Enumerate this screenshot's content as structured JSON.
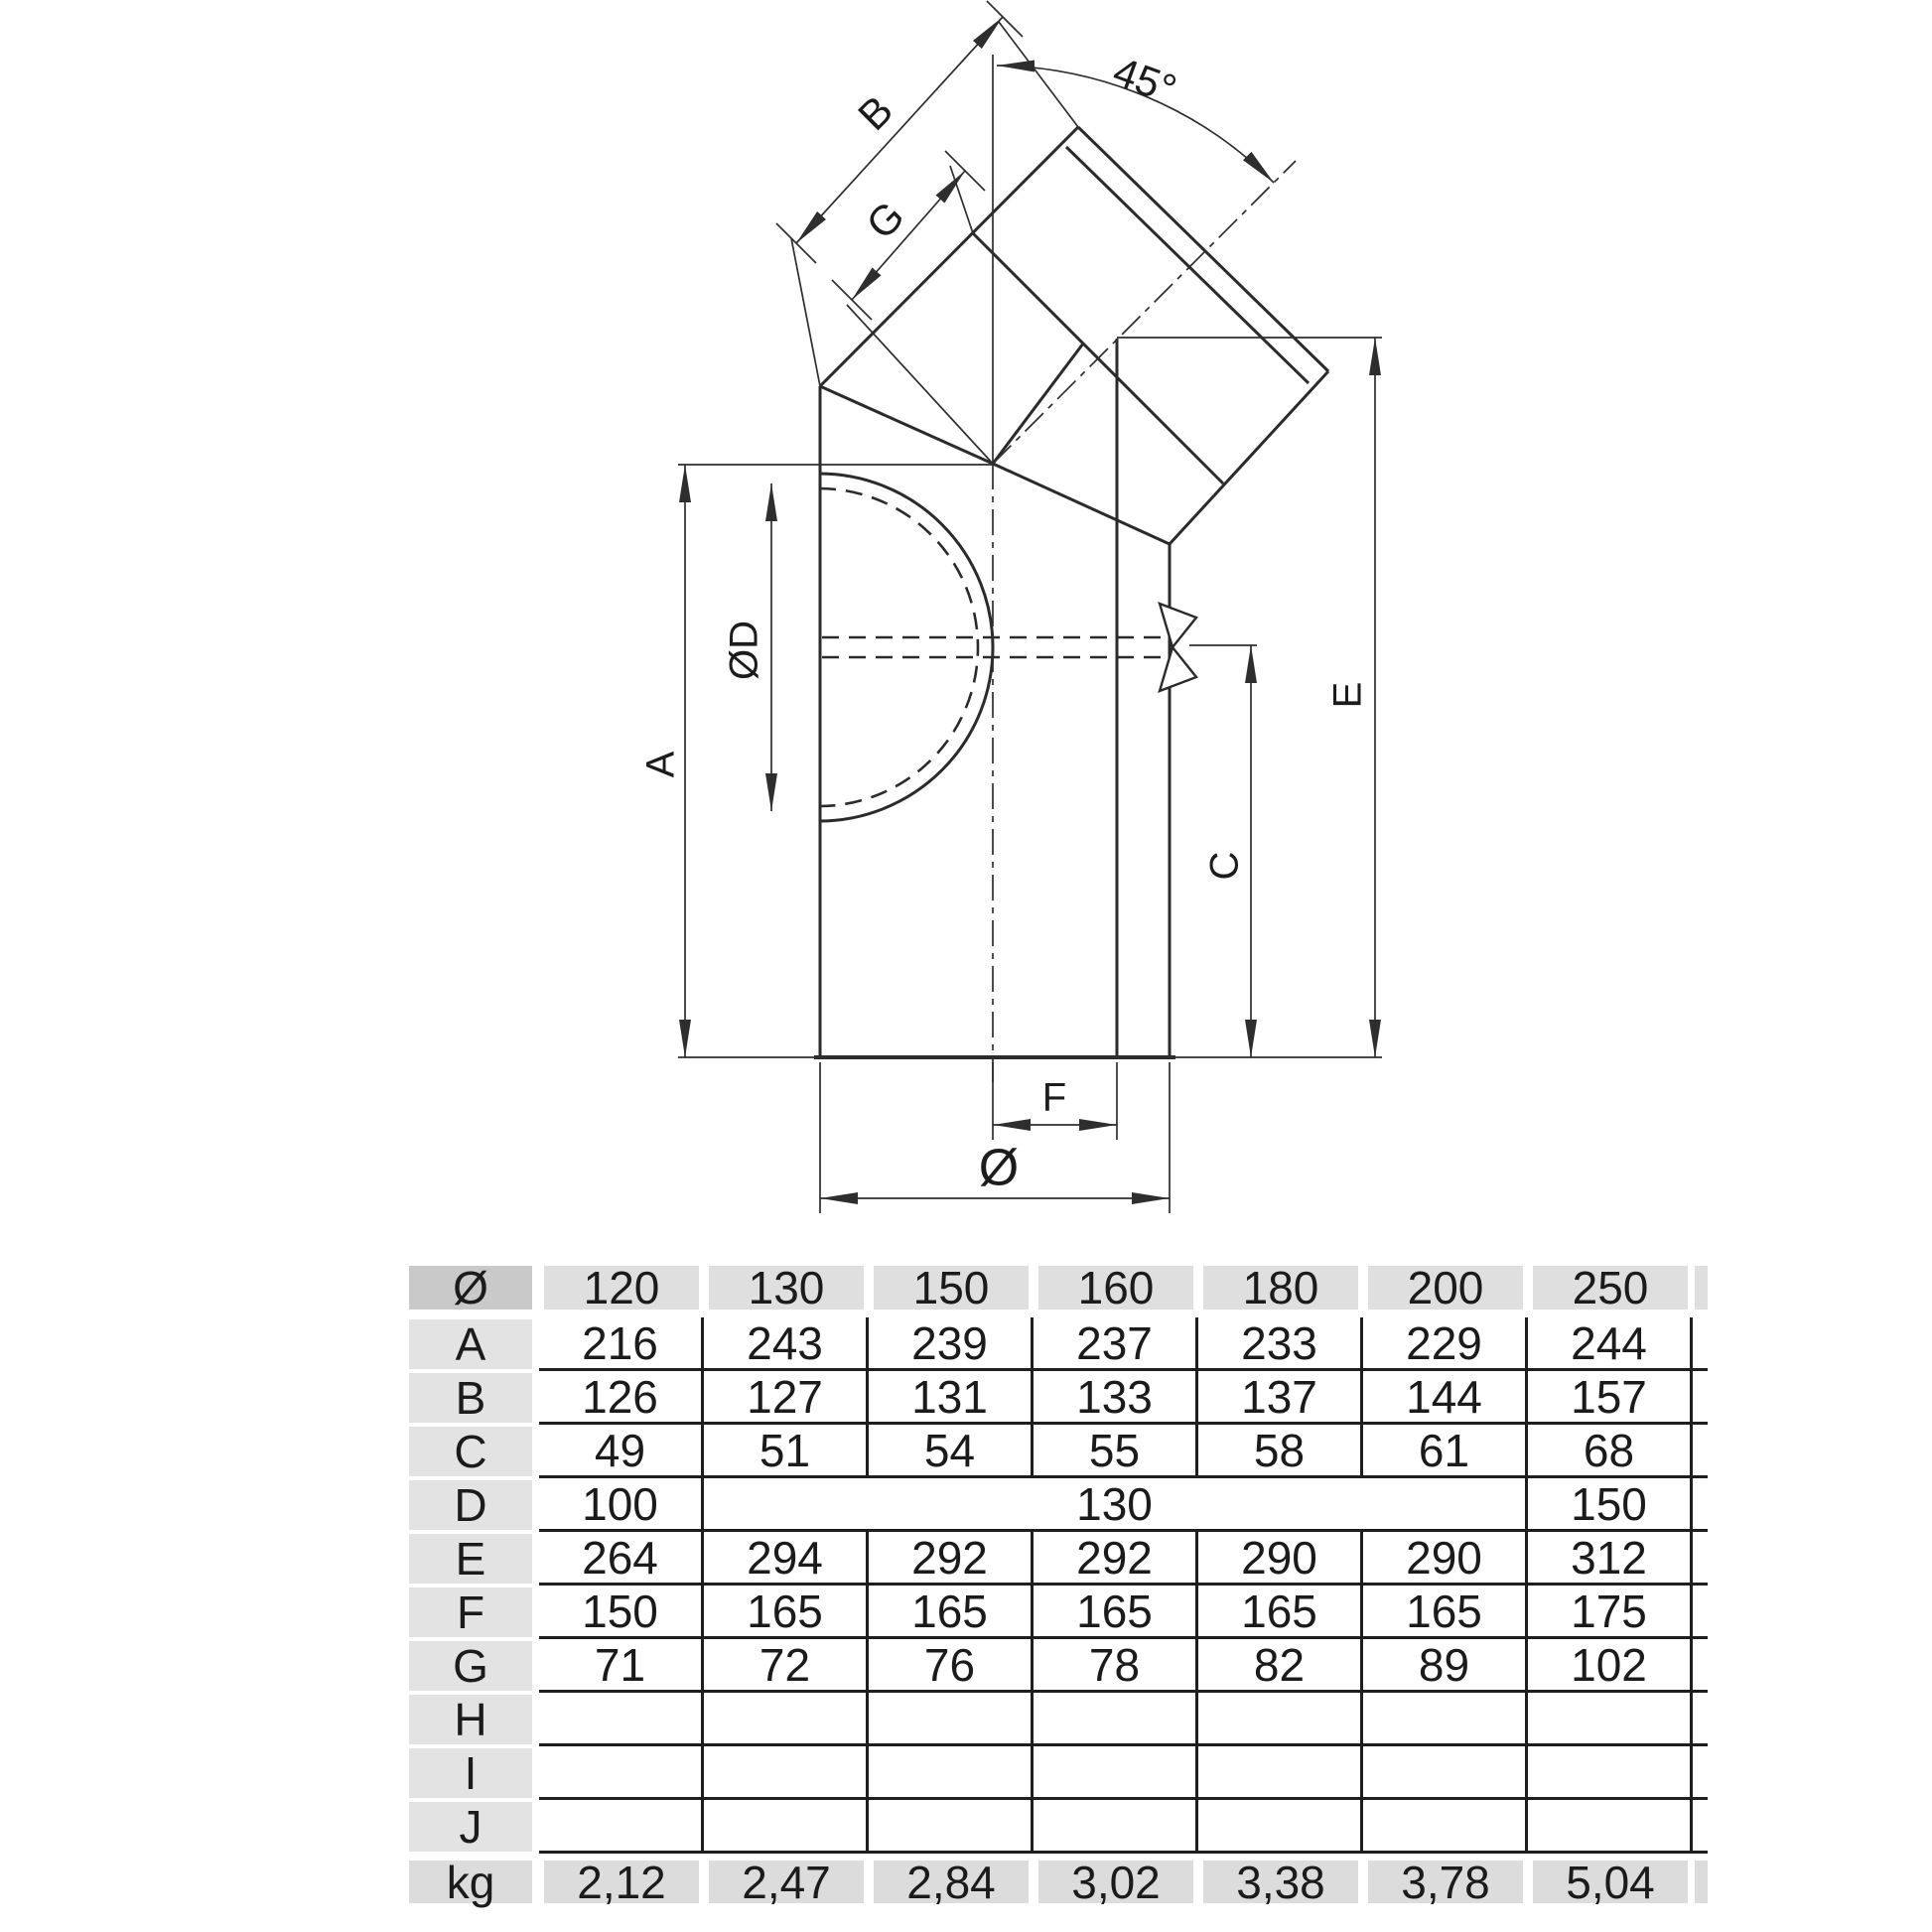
{
  "drawing": {
    "labels": {
      "a": "A",
      "b": "B",
      "c": "C",
      "d": "ØD",
      "e": "E",
      "f": "F",
      "g": "G",
      "diameter": "Ø",
      "angle": "45°"
    }
  },
  "table": {
    "header": {
      "label": "Ø",
      "values": [
        "120",
        "130",
        "150",
        "160",
        "180",
        "200",
        "250"
      ]
    },
    "rows": [
      {
        "label": "A",
        "cells": [
          {
            "v": "216"
          },
          {
            "v": "243"
          },
          {
            "v": "239"
          },
          {
            "v": "237"
          },
          {
            "v": "233"
          },
          {
            "v": "229"
          },
          {
            "v": "244"
          }
        ]
      },
      {
        "label": "B",
        "cells": [
          {
            "v": "126"
          },
          {
            "v": "127"
          },
          {
            "v": "131"
          },
          {
            "v": "133"
          },
          {
            "v": "137"
          },
          {
            "v": "144"
          },
          {
            "v": "157"
          }
        ]
      },
      {
        "label": "C",
        "cells": [
          {
            "v": "49"
          },
          {
            "v": "51"
          },
          {
            "v": "54"
          },
          {
            "v": "55"
          },
          {
            "v": "58"
          },
          {
            "v": "61"
          },
          {
            "v": "68"
          }
        ]
      },
      {
        "label": "D",
        "cells": [
          {
            "v": "100"
          },
          {
            "v": "130",
            "span": 5
          },
          {
            "v": "150"
          }
        ]
      },
      {
        "label": "E",
        "cells": [
          {
            "v": "264"
          },
          {
            "v": "294"
          },
          {
            "v": "292"
          },
          {
            "v": "292"
          },
          {
            "v": "290"
          },
          {
            "v": "290"
          },
          {
            "v": "312"
          }
        ]
      },
      {
        "label": "F",
        "cells": [
          {
            "v": "150"
          },
          {
            "v": "165"
          },
          {
            "v": "165"
          },
          {
            "v": "165"
          },
          {
            "v": "165"
          },
          {
            "v": "165"
          },
          {
            "v": "175"
          }
        ]
      },
      {
        "label": "G",
        "cells": [
          {
            "v": "71"
          },
          {
            "v": "72"
          },
          {
            "v": "76"
          },
          {
            "v": "78"
          },
          {
            "v": "82"
          },
          {
            "v": "89"
          },
          {
            "v": "102"
          }
        ]
      },
      {
        "label": "H",
        "cells": [
          {
            "v": ""
          },
          {
            "v": ""
          },
          {
            "v": ""
          },
          {
            "v": ""
          },
          {
            "v": ""
          },
          {
            "v": ""
          },
          {
            "v": ""
          }
        ]
      },
      {
        "label": "I",
        "cells": [
          {
            "v": ""
          },
          {
            "v": ""
          },
          {
            "v": ""
          },
          {
            "v": ""
          },
          {
            "v": ""
          },
          {
            "v": ""
          },
          {
            "v": ""
          }
        ]
      },
      {
        "label": "J",
        "cells": [
          {
            "v": ""
          },
          {
            "v": ""
          },
          {
            "v": ""
          },
          {
            "v": ""
          },
          {
            "v": ""
          },
          {
            "v": ""
          },
          {
            "v": ""
          }
        ]
      }
    ],
    "footer": {
      "label": "kg",
      "values": [
        "2,12",
        "2,47",
        "2,84",
        "3,02",
        "3,38",
        "3,78",
        "5,04"
      ]
    }
  }
}
